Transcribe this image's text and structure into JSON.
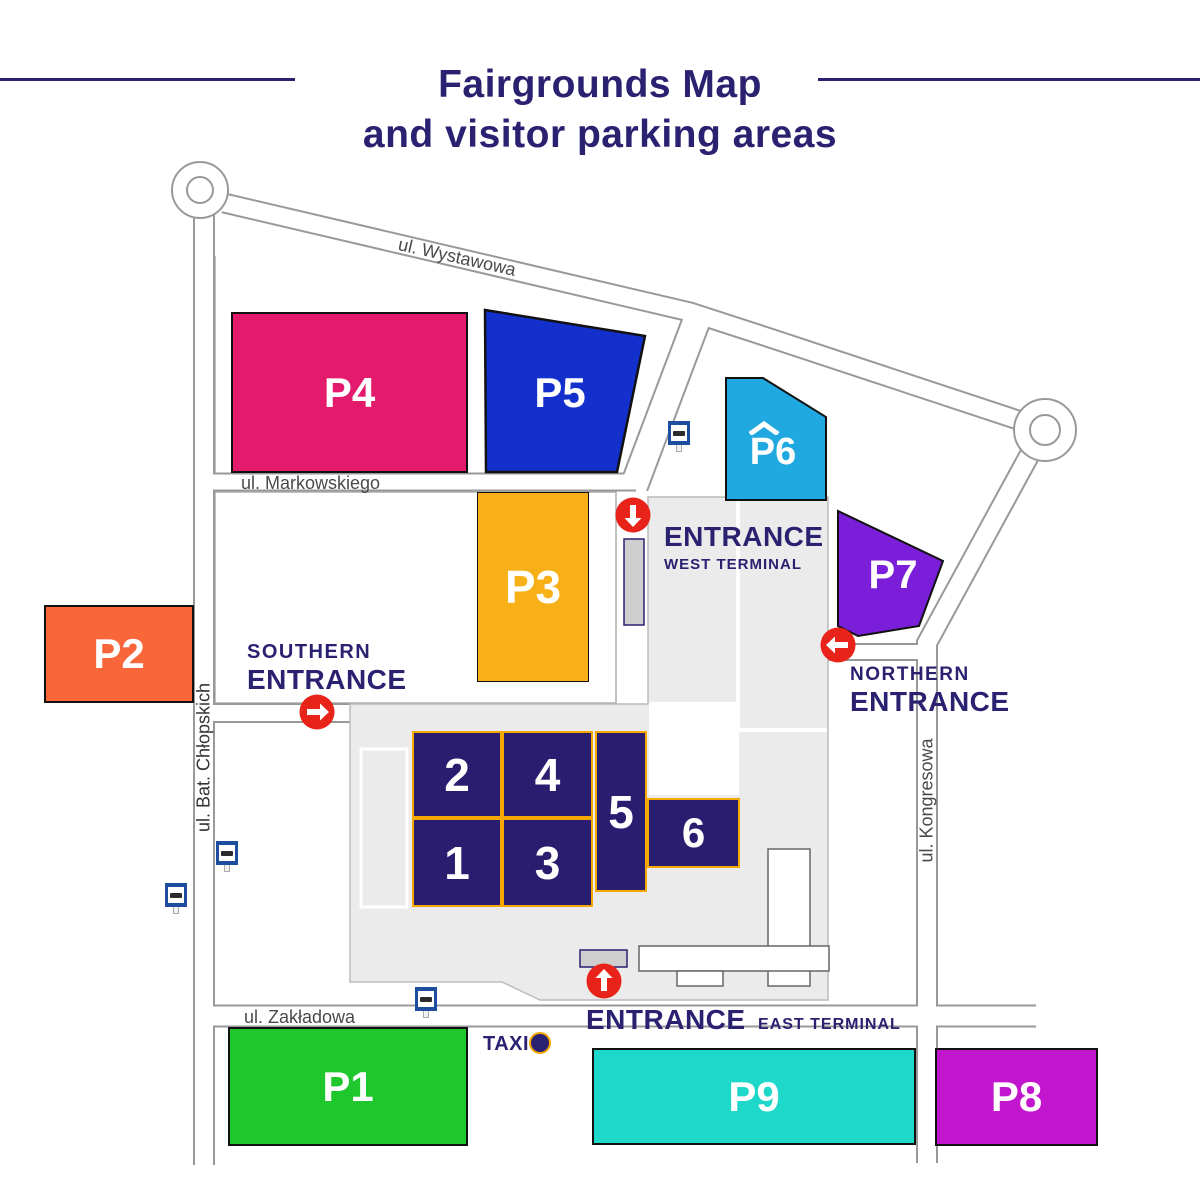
{
  "title": {
    "line1": "Fairgrounds Map",
    "line2": "and visitor parking areas"
  },
  "streets": {
    "wystawowa": "ul. Wystawowa",
    "markowskiego": "ul. Markowskiego",
    "bat_chlopskich": "ul. Bat. Chłopskich",
    "kongresowa": "ul. Kongresowa",
    "zakladowa": "ul. Zakładowa"
  },
  "parkings": {
    "p1": {
      "label": "P1",
      "color": "#1EC72B"
    },
    "p2": {
      "label": "P2",
      "color": "#F9663A"
    },
    "p3": {
      "label": "P3",
      "color": "#F8B018"
    },
    "p4": {
      "label": "P4",
      "color": "#E41A6D"
    },
    "p5": {
      "label": "P5",
      "color": "#1430CC"
    },
    "p6": {
      "label": "P6",
      "color": "#20A8E0",
      "roof_glyph": "^"
    },
    "p7": {
      "label": "P7",
      "color": "#7A1ED9"
    },
    "p8": {
      "label": "P8",
      "color": "#C216CE"
    },
    "p9": {
      "label": "P9",
      "color": "#1ED9C9"
    }
  },
  "halls": {
    "h1": "1",
    "h2": "2",
    "h3": "3",
    "h4": "4",
    "h5": "5",
    "h6": "6"
  },
  "entrances": {
    "southern": {
      "line1": "SOUTHERN",
      "line2": "ENTRANCE",
      "arrow": "right"
    },
    "northern": {
      "line1": "NORTHERN",
      "line2": "ENTRANCE",
      "arrow": "left"
    },
    "west": {
      "line1": "ENTRANCE",
      "line2": "WEST TERMINAL",
      "arrow": "down"
    },
    "east": {
      "line1": "ENTRANCE",
      "line2": "EAST TERMINAL",
      "arrow": "up"
    }
  },
  "taxi": {
    "label": "TAXI"
  },
  "icons": {
    "bus_stop": "blue-square-bus-sign",
    "taxi_stand": "navy-circle-with-orange-ring",
    "entrance_arrow": "white-arrow-in-red-circle",
    "roundabout": "double-circle"
  },
  "colors": {
    "navy": "#2B2171",
    "road_line": "#999999",
    "street_text": "#4A4A4A",
    "grounds_fill": "#EBEBEB",
    "hall_fill": "#2A1D70",
    "hall_border": "#F5A800",
    "arrow_red": "#E8231A",
    "bus_blue": "#1D4D9F"
  }
}
